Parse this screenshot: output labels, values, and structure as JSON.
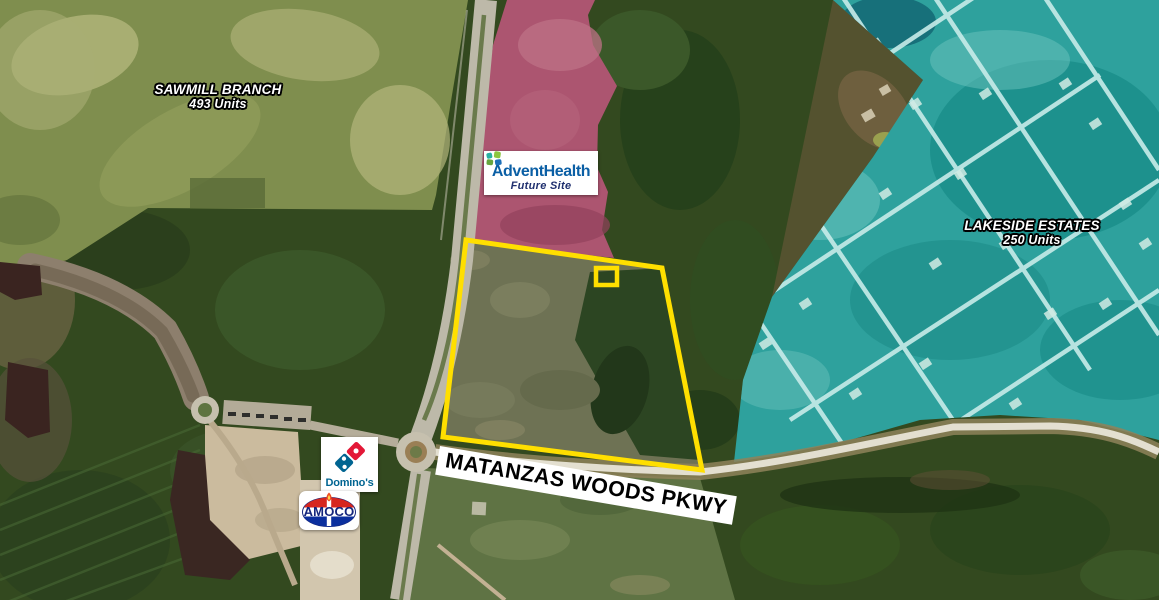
{
  "map": {
    "regions": {
      "sawmill": {
        "line1": "SAWMILL BRANCH",
        "line2": "493 Units"
      },
      "lakeside": {
        "line1": "LAKESIDE ESTATES",
        "line2": "250 Units"
      },
      "advent": {
        "brand": "AdventHealth",
        "subtitle": "Future Site"
      }
    },
    "road_label": "MATANZAS WOODS PKWY",
    "businesses": {
      "dominos": {
        "name": "Domino's"
      },
      "amoco": {
        "name": "AMOCO"
      }
    }
  },
  "colors": {
    "parcel_outline": "#FFDF00",
    "sawmill_region": "#7F8E4E",
    "advent_region": "#AC5570",
    "lakeside_region": "#2EA19D",
    "advent_blue": "#0B5FA5",
    "advent_navy": "#1F2F6E",
    "advent_leaf_teal": "#29B0A2",
    "advent_leaf_light_green": "#8CC63F",
    "advent_leaf_green": "#66A53E",
    "advent_leaf_blue": "#1D6FB8",
    "dominos_blue": "#006491",
    "dominos_red": "#E31837",
    "amoco_red": "#D6261F",
    "amoco_blue": "#0B2F9E",
    "amoco_text": "#15267D",
    "label_text": "#FFFFFF",
    "road_label_text": "#000000"
  }
}
